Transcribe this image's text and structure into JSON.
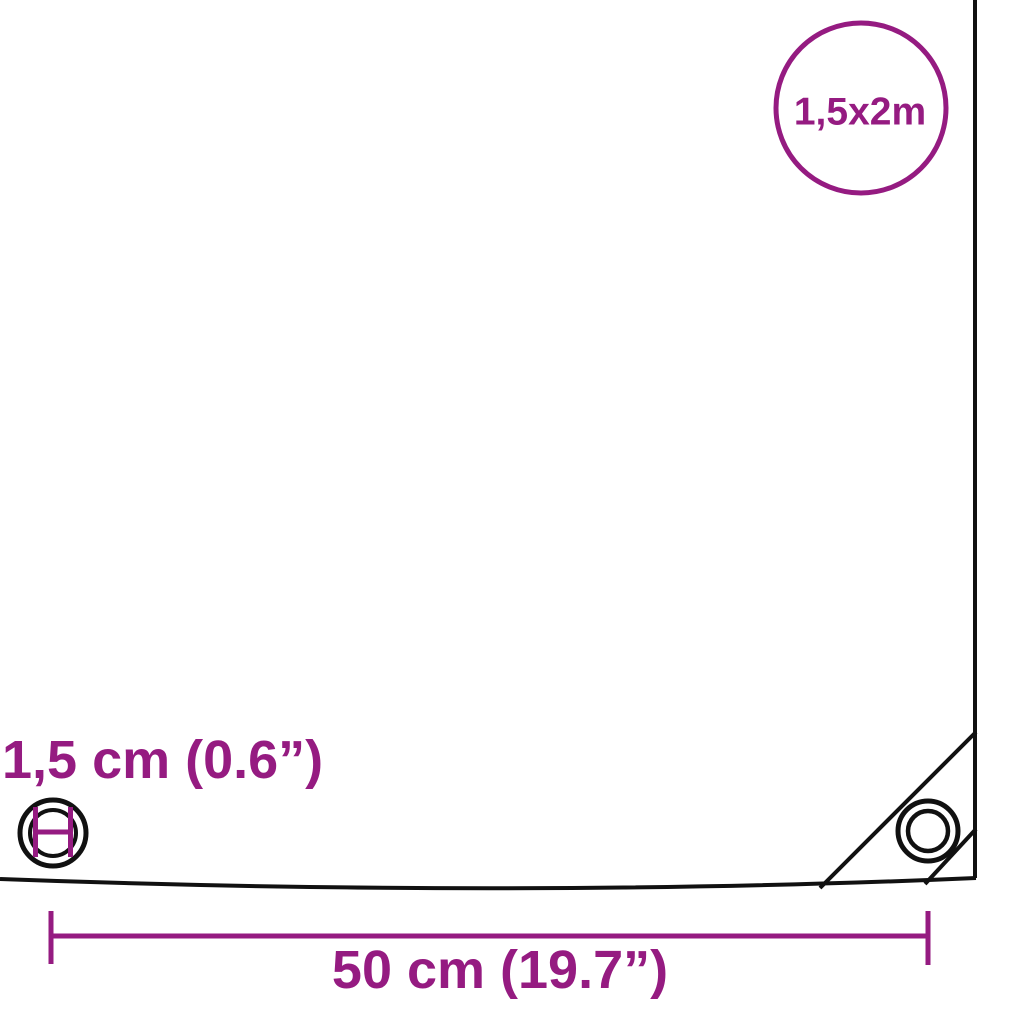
{
  "colors": {
    "accent": "#951B81",
    "line": "#111111",
    "surface": "#FFFFFF"
  },
  "diagram": {
    "size_badge": {
      "label": "1,5x2m"
    },
    "eyelet_diameter_label": "1,5 cm (0.6”)",
    "eyelet_spacing_label": "50 cm (19.7”)"
  },
  "icons": {
    "size-badge-circle": "purple circle outline badge",
    "eyelet-diameter-icon": "grommet ring with purple diameter measure mark",
    "corner-eyelet-icon": "double-ring grommet in reinforced corner",
    "dimension-line": "horizontal measure line with end ticks"
  }
}
